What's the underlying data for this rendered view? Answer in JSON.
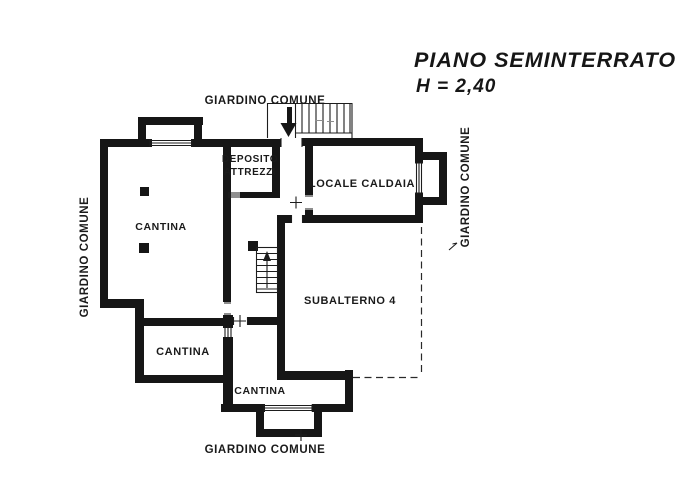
{
  "title": {
    "name": "PIANO SEMINTERRATO",
    "height": "H = 2,40"
  },
  "garden_labels": {
    "top": "GIARDINO COMUNE",
    "bottom": "GIARDINO COMUNE",
    "left": "GIARDINO COMUNE",
    "right": "GIARDINO COMUNE"
  },
  "rooms": {
    "cantina_main": "CANTINA",
    "cantina_southwest": "CANTINA",
    "cantina_south": "CANTINA",
    "deposito_line1": "DEPOSITO",
    "deposito_line2": "ATTREZZI",
    "locale_caldaia": "LOCALE CALDAIA",
    "subalterno": "SUBALTERNO 4"
  },
  "colors": {
    "ink": "#161616",
    "paper": "#ffffff"
  }
}
